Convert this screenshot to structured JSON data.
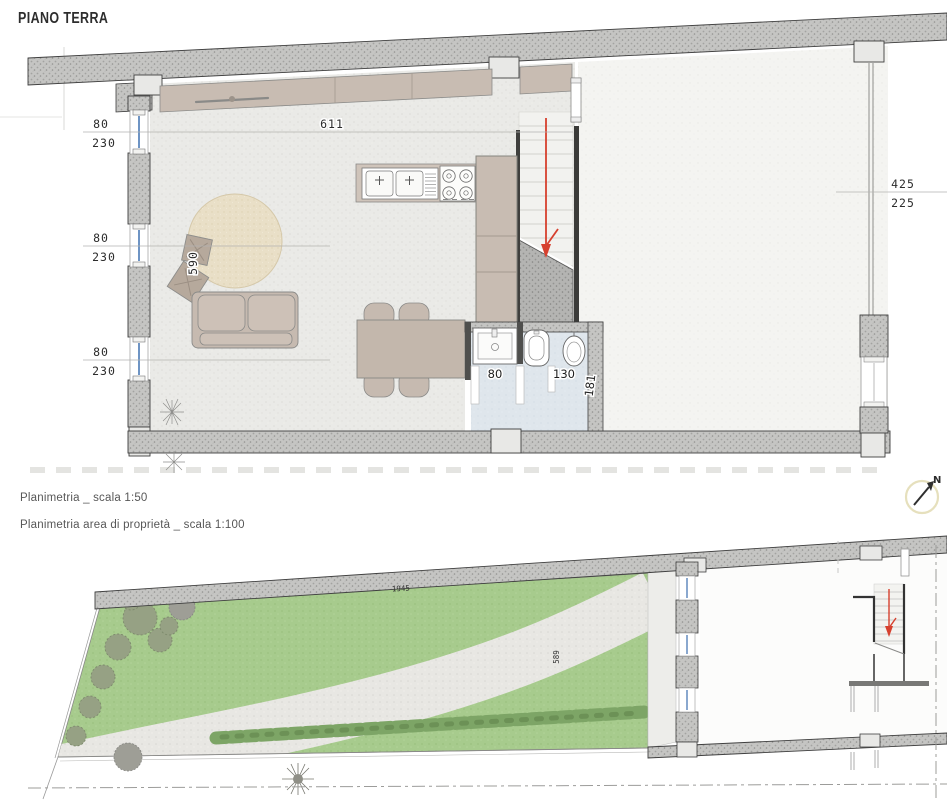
{
  "title": "PIANO TERRA",
  "captions": {
    "plan_1_50": "Planimetria _ scala 1:50",
    "plan_1_100": "Planimetria area di proprietà _ scala 1:100"
  },
  "compass": {
    "north_label": "N"
  },
  "floor_plan": {
    "dim_total_width": "611",
    "dim_living_depth": "590",
    "left_windows": [
      {
        "width": "80",
        "height": "230"
      },
      {
        "width": "80",
        "height": "230"
      },
      {
        "width": "80",
        "height": "230"
      }
    ],
    "right_opening": {
      "width": "425",
      "height": "225"
    },
    "bathroom": {
      "dim_basin_zone": "80",
      "dim_wc_zone": "130",
      "dim_depth": "181"
    }
  },
  "site_plan": {
    "dim_garden_length": "1945",
    "dim_garden_width": "589"
  },
  "colors": {
    "wall_fill": "#c5c5c3",
    "floor_fill": "#eaeae7",
    "terrace_fill": "#f4f4f1",
    "garden_fill": "#a7cb8d",
    "path_fill": "#e8e7e3",
    "bath_floor_fill": "#dfe6ec",
    "furniture_fill": "#c6bab0",
    "rug_fill": "#e9dfc7",
    "window_line": "#4a7ab5",
    "stair_arrow": "#d6402e",
    "hedge_fill": "#7da566"
  }
}
